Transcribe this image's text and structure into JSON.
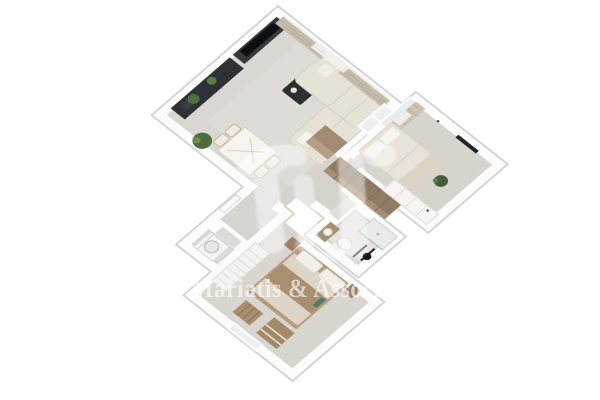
{
  "watermark": {
    "text": "Mariatis & Associa",
    "color": "#ffffff",
    "opacity": 0.62,
    "logo": "abstract-monogram-watermark"
  },
  "scene": {
    "type": "3d-floor-plan-render-top-view",
    "background": "#ffffff",
    "rooms": [
      {
        "name": "living-room",
        "furniture": [
          "dark-sideboard",
          "tv-screen",
          "media-console",
          "coffee-table",
          "l-shaped-sofa",
          "marble-dining-table",
          "dining-chairs",
          "floor-plant",
          "curtains",
          "kitchen-counter"
        ]
      },
      {
        "name": "bedroom-right",
        "furniture": [
          "double-bed",
          "pillows",
          "white-wardrobe",
          "curtains",
          "plant"
        ]
      },
      {
        "name": "bathroom",
        "furniture": [
          "toilet",
          "shower",
          "vanity-sink",
          "black-towel-rack"
        ]
      },
      {
        "name": "master-bedroom",
        "furniture": [
          "double-bed",
          "brown-blanket",
          "slatted-wardrobe",
          "ladder-shelf",
          "dresser",
          "nightstand"
        ]
      },
      {
        "name": "laundry-room",
        "furniture": [
          "washing-machine"
        ]
      },
      {
        "name": "hallway",
        "furniture": [
          "corridor-closet"
        ]
      }
    ],
    "palette": {
      "floor": "#d8d5d0",
      "wall_white": "#fcfcfb",
      "wall_edge": "#d7d4d0",
      "dark_furniture": "#2b2f32",
      "tv_black": "#121415",
      "sofa_beige": "#e7e2d6",
      "curtain_beige": "#c6bcaa",
      "wood_closet": "#8f7a64",
      "bed_wood": "#b59c7e",
      "blanket_tan": "#a98e6f",
      "plant_green": "#4e6e3d",
      "bathroom_floor": "#e4e3e0"
    }
  }
}
